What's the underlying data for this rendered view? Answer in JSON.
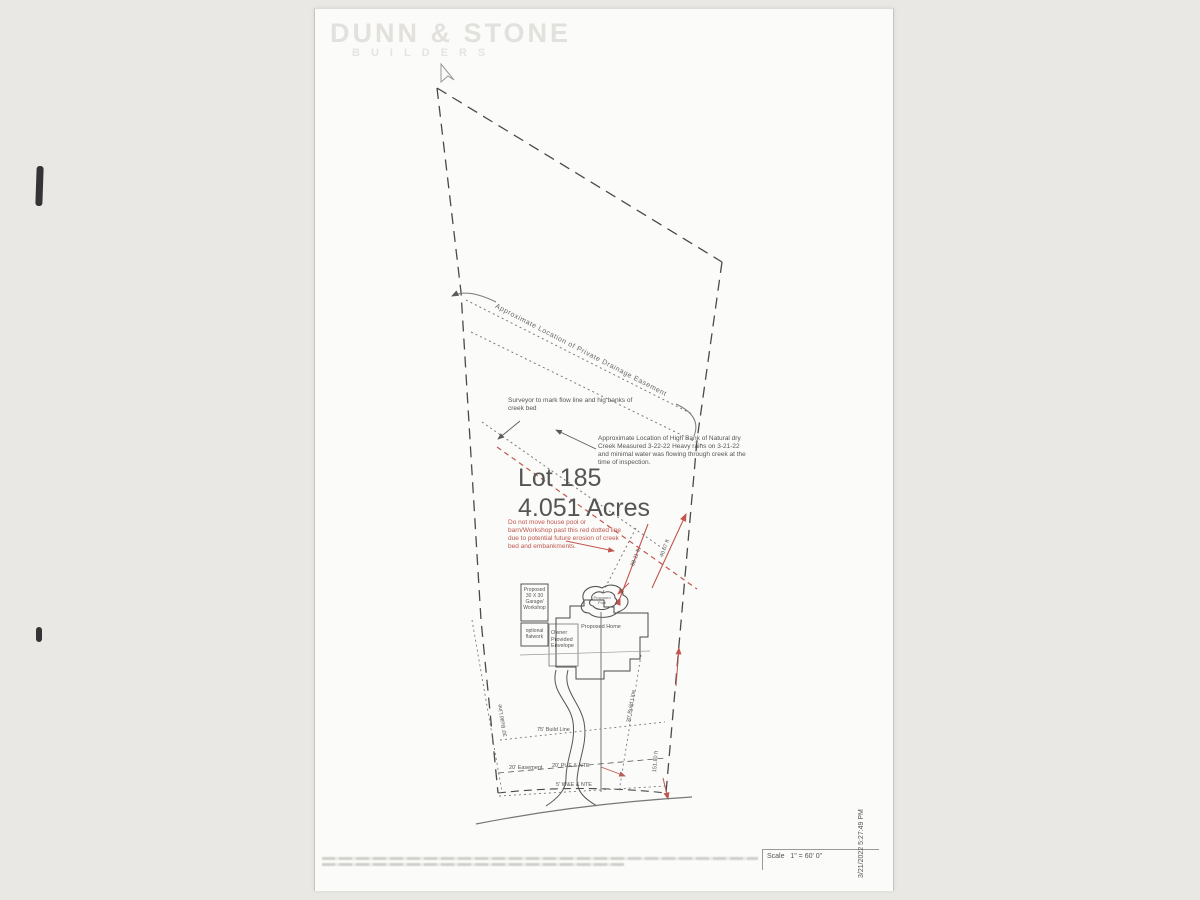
{
  "watermark": {
    "name": "DUNN & STONE",
    "subtitle": "BUILDERS"
  },
  "lot": {
    "name": "Lot 185",
    "area": "4.051 Acres"
  },
  "notes": {
    "drainage": "Approximate Location of Private Drainage Easement",
    "surveyor": "Surveyor to mark flow line and hig banks of creek bed",
    "high_bank": "Approximate Location of High Bank of Natural dry Creek  Measured 3-22-22  Heavy rains on 3-21-22 and minimal water was flowing through creek at the time of inspection.",
    "warning": "Do not move house pool or barn/Workshop past this red dotted line due to potential future erosion of creek bed and embankments."
  },
  "structures": {
    "garage": "Proposed 30 X 30 Garage/ Workshop",
    "flatwork": "optional flatwork",
    "envelope": "Owner Provided Envelope",
    "home": "Proposed Home",
    "pool": "Proposed Pool"
  },
  "site_lines": {
    "build75": "75' Build Line",
    "build30_left": "30' Build Line",
    "build30_right": "30' Build Line",
    "easement20": "20' Easement",
    "pue": "20' PUE & NTE",
    "we": "5' W&E & NTE"
  },
  "dimensions": {
    "creek_offset_1": "88.11 ft",
    "creek_offset_2": "40.07 ft",
    "east_boundary": "151.80 ft"
  },
  "footer": {
    "scale_label": "Scale",
    "scale_value": "1\" = 60' 0\"",
    "timestamp": "3/21/2022 5:27:49 PM"
  },
  "colors": {
    "ink": "#4a4a4a",
    "dotted": "#7a7a7a",
    "red": "#c0564f",
    "paper": "#fbfbf9",
    "background": "#e9e8e5",
    "watermark": "#e2e1dd"
  }
}
